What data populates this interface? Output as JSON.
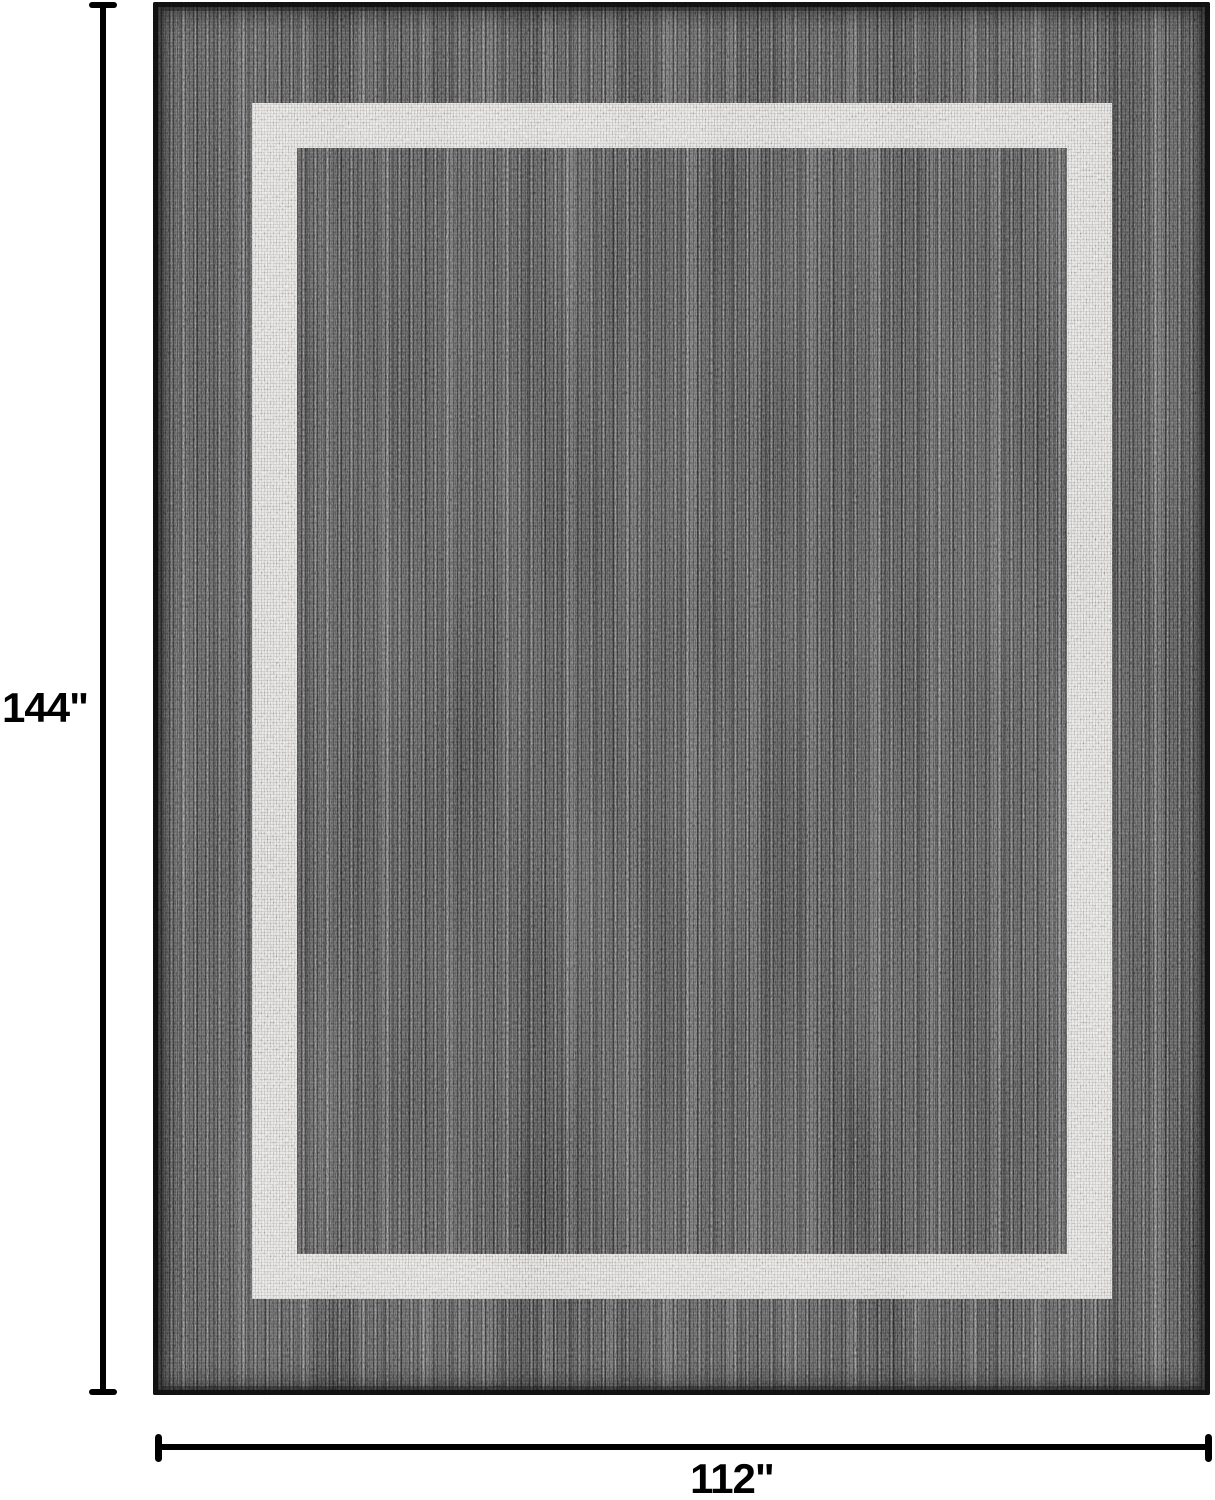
{
  "figure": {
    "height_label": "144\"",
    "width_label": "112\""
  },
  "rug": {
    "description": "Dark charcoal heathered flatweave area rug with a light gray rectangular border stripe",
    "colors": {
      "background": "#ffffff",
      "dimension": "#000000",
      "base": "#474747",
      "binding": "#181818",
      "stripe": "#d9d7d3"
    }
  }
}
